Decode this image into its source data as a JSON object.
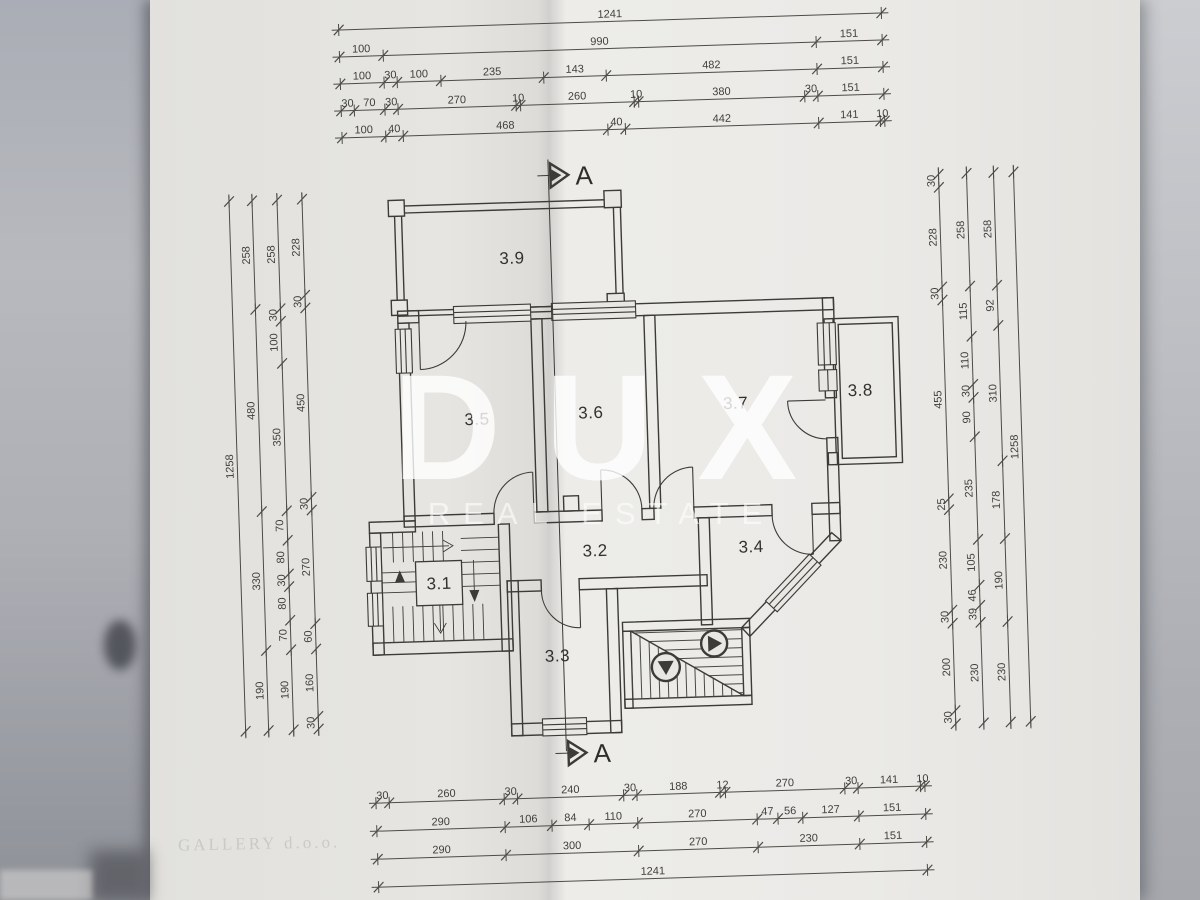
{
  "watermark": {
    "brand": "DUX",
    "subtitle": "REAL ESTATE"
  },
  "stamp": {
    "text": "GALLERY d.o.o."
  },
  "section": {
    "label": "A"
  },
  "rooms": [
    {
      "label": "3.1",
      "x": 435,
      "y": 584
    },
    {
      "label": "3.2",
      "x": 592,
      "y": 556
    },
    {
      "label": "3.3",
      "x": 551,
      "y": 660
    },
    {
      "label": "3.4",
      "x": 748,
      "y": 557
    },
    {
      "label": "3.5",
      "x": 478,
      "y": 421
    },
    {
      "label": "3.6",
      "x": 592,
      "y": 418
    },
    {
      "label": "3.7",
      "x": 737,
      "y": 413
    },
    {
      "label": "3.8",
      "x": 862,
      "y": 404
    },
    {
      "label": "3.9",
      "x": 518,
      "y": 261
    }
  ],
  "dimensions": {
    "top": {
      "origin": 352,
      "scale": 0.4375,
      "rows": [
        {
          "y": 22,
          "segments": [
            1241
          ]
        },
        {
          "y": 49,
          "segments": [
            100,
            990,
            151
          ]
        },
        {
          "y": 76,
          "segments": [
            100,
            30,
            100,
            235,
            143,
            482,
            151
          ]
        },
        {
          "y": 103,
          "segments": [
            30,
            70,
            30,
            270,
            10,
            260,
            10,
            380,
            30,
            151
          ]
        },
        {
          "y": 130,
          "segments": [
            100,
            40,
            468,
            40,
            442,
            141,
            10
          ]
        }
      ]
    },
    "bottom": {
      "origin": 365,
      "scale": 0.4425,
      "rows": [
        {
          "y": 796,
          "segments": [
            30,
            260,
            30,
            240,
            30,
            188,
            12,
            270,
            30,
            141,
            10
          ]
        },
        {
          "y": 824,
          "segments": [
            290,
            106,
            84,
            110,
            270,
            47,
            56,
            127,
            151
          ]
        },
        {
          "y": 852,
          "segments": [
            290,
            300,
            270,
            230,
            151
          ]
        },
        {
          "y": 880,
          "segments": [
            1241
          ]
        }
      ]
    },
    "left": {
      "origin": 190,
      "scale": 0.4213,
      "cols": [
        {
          "x": 237,
          "segments": [
            1258
          ]
        },
        {
          "x": 260,
          "segments": [
            258,
            480,
            330,
            190
          ]
        },
        {
          "x": 285,
          "segments": [
            258,
            30,
            100,
            350,
            70,
            80,
            30,
            80,
            70,
            190
          ]
        },
        {
          "x": 310,
          "segments": [
            228,
            30,
            450,
            30,
            270,
            60,
            160,
            30
          ]
        }
      ]
    },
    "right": {
      "origin": 185,
      "scale": 0.437,
      "cols": [
        {
          "x": 947,
          "segments": [
            30,
            228,
            30,
            455,
            25,
            230,
            30,
            200,
            30
          ]
        },
        {
          "x": 975,
          "segments": [
            258,
            115,
            110,
            30,
            90,
            235,
            105,
            46,
            39,
            230
          ]
        },
        {
          "x": 1002,
          "segments": [
            258,
            92,
            310,
            178,
            190,
            230
          ]
        },
        {
          "x": 1022,
          "segments": [
            1258
          ]
        }
      ]
    }
  }
}
